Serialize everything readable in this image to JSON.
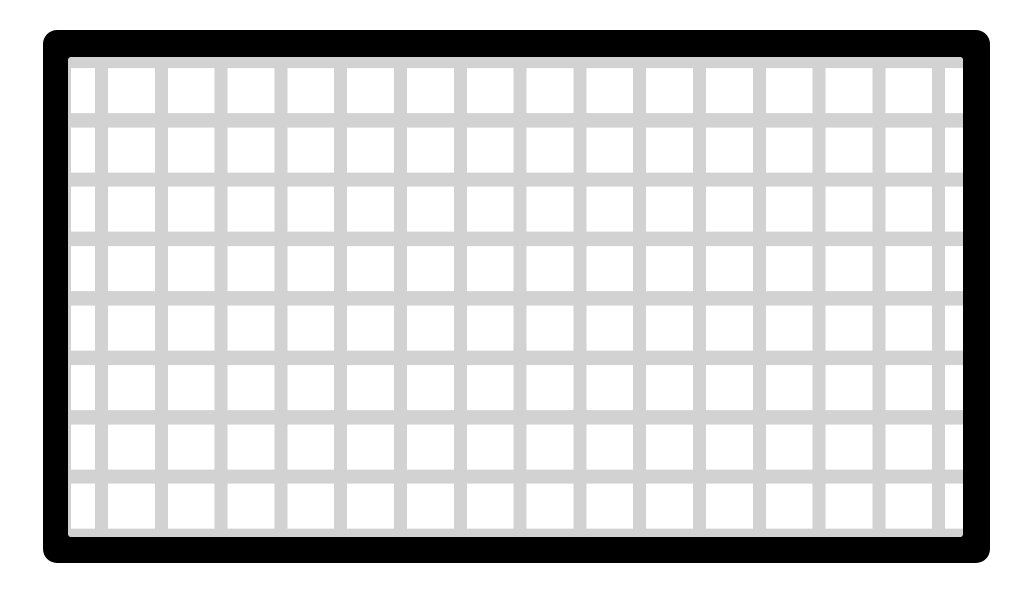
{
  "graphic": {
    "type": "grid-pattern-icon",
    "alt": "Black rounded rectangle frame enclosing a light gray grid of white squares",
    "grid": {
      "rows": 8,
      "columns": 16,
      "line_thickness_px": 13,
      "cell_size_px": 46
    },
    "colors": {
      "frame": "#000000",
      "grid_line": "#d2d2d2",
      "cell": "#ffffff",
      "page_background": "#ffffff"
    }
  }
}
